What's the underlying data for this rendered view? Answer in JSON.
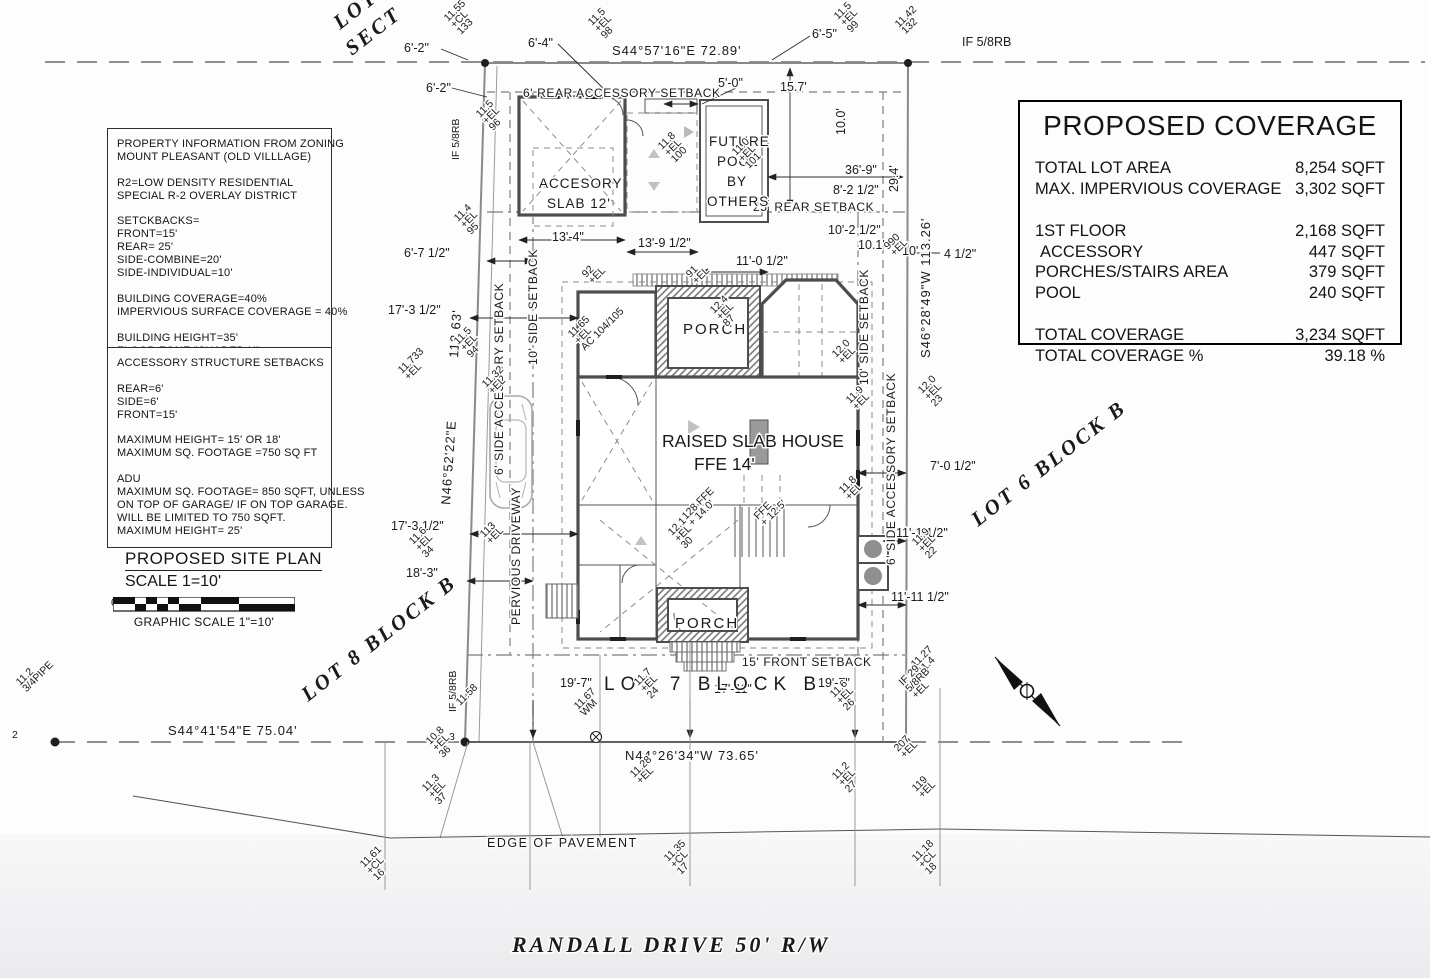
{
  "info_box1": {
    "lines": [
      "PROPERTY INFORMATION FROM ZONING",
      "MOUNT PLEASANT (OLD VILLLAGE)",
      "",
      "R2=LOW DENSITY RESIDENTIAL",
      "SPECIAL R-2 OVERLAY DISTRICT",
      "",
      "SETCKBACKS=",
      "FRONT=15'",
      "REAR= 25'",
      "SIDE-COMBINE=20'",
      "SIDE-INDIVIDUAL=10'",
      "",
      "BUILDING COVERAGE=40%",
      "IMPERVIOUS SURFACE COVERAGE = 40%",
      "",
      "BUILDING HEIGHT=35'",
      "FLOOD ZONE \"SHADED X\""
    ]
  },
  "info_box2": {
    "lines": [
      "ACCESSORY STRUCTURE SETBACKS",
      "",
      "REAR=6'",
      "SIDE=6'",
      "FRONT=15'",
      "",
      "MAXIMUM HEIGHT= 15' OR 18'",
      "MAXIMUM SQ. FOOTAGE =750 SQ FT",
      "",
      "ADU",
      "MAXIMUM SQ. FOOTAGE= 850 SQFT, UNLESS",
      "ON TOP OF GARAGE/ IF ON TOP GARAGE.",
      "WILL BE LIMITED TO 750 SQFT.",
      "MAXIMUM HEIGHT= 25'"
    ]
  },
  "site_plan": {
    "title": "PROPOSED SITE PLAN",
    "scale": "SCALE 1=10'",
    "graphic": "GRAPHIC SCALE 1\"=10'",
    "ticks": [
      "0",
      "10'",
      "20'",
      "30'"
    ]
  },
  "coverage": {
    "title": "PROPOSED COVERAGE",
    "rows": [
      {
        "label": "TOTAL LOT AREA",
        "value": "8,254 SQFT"
      },
      {
        "label": "MAX. IMPERVIOUS COVERAGE",
        "value": "3,302 SQFT"
      },
      {
        "label": "1ST FLOOR",
        "value": "2,168 SQFT",
        "gap": true
      },
      {
        "label": "ACCESSORY",
        "value": "447 SQFT",
        "indent": true
      },
      {
        "label": "PORCHES/STAIRS AREA",
        "value": "379 SQFT"
      },
      {
        "label": "POOL",
        "value": "240 SQFT"
      },
      {
        "label": "TOTAL COVERAGE",
        "value": "3,234 SQFT",
        "gap": true
      },
      {
        "label": "TOTAL COVERAGE %",
        "value": "39.18 %"
      }
    ]
  },
  "plan": {
    "labels": [
      {
        "t": "S44°57'16\"E   72.89'",
        "x": 612,
        "y": 55,
        "c": "b",
        "n": "bearing-north"
      },
      {
        "t": "N44°26'34\"W  73.65'",
        "x": 625,
        "y": 760,
        "c": "b",
        "n": "bearing-south"
      },
      {
        "t": "S44°41'54\"E  75.04'",
        "x": 168,
        "y": 735,
        "c": "b",
        "n": "bearing-southwest"
      },
      {
        "t": "N46°52'22\"E",
        "x": 450,
        "y": 505,
        "r": -86,
        "c": "b",
        "n": "bearing-west"
      },
      {
        "t": "112.63'",
        "x": 458,
        "y": 358,
        "r": -86,
        "c": "b",
        "n": "west-line-length"
      },
      {
        "t": "S46°28'49\"W 113.26'",
        "x": 930,
        "y": 358,
        "r": -90,
        "c": "b",
        "n": "bearing-east"
      },
      {
        "t": "6'-2\"",
        "x": 404,
        "y": 52,
        "c": "d"
      },
      {
        "t": "6'-2\"",
        "x": 426,
        "y": 92,
        "c": "d"
      },
      {
        "t": "6'-4\"",
        "x": 528,
        "y": 47,
        "c": "d"
      },
      {
        "t": "6'-5\"",
        "x": 812,
        "y": 38,
        "c": "d"
      },
      {
        "t": "5'-0\"",
        "x": 718,
        "y": 87,
        "c": "d"
      },
      {
        "t": "15.7'",
        "x": 780,
        "y": 91,
        "c": "d"
      },
      {
        "t": "IF 5/8RB",
        "x": 962,
        "y": 46,
        "c": "d",
        "n": "iron-found-marker"
      },
      {
        "t": "IF 5/8RB",
        "x": 459,
        "y": 160,
        "r": -90,
        "c": "v",
        "n": "iron-found-marker"
      },
      {
        "t": "IF 5/8RB",
        "x": 456,
        "y": 712,
        "r": -90,
        "c": "v",
        "n": "iron-found-marker"
      },
      {
        "t": "2",
        "x": 12,
        "y": 738,
        "c": "v",
        "n": "point-number"
      },
      {
        "t": "3",
        "x": 449,
        "y": 740,
        "c": "v",
        "n": "point-number"
      },
      {
        "t": "6' REAR ACCESSORY SETBACK",
        "x": 523,
        "y": 97,
        "c": "s",
        "n": "setback-label"
      },
      {
        "t": "25' REAR SETBACK",
        "x": 753,
        "y": 211,
        "c": "s",
        "n": "setback-label"
      },
      {
        "t": "15' FRONT SETBACK",
        "x": 742,
        "y": 666,
        "c": "s",
        "n": "setback-label"
      },
      {
        "t": "10' SIDE SETBACK",
        "x": 537,
        "y": 365,
        "r": -90,
        "c": "s",
        "n": "setback-label"
      },
      {
        "t": "6' SIDE ACCESSORY SETBACK",
        "x": 503,
        "y": 475,
        "r": -90,
        "c": "s",
        "n": "setback-label"
      },
      {
        "t": "10' SIDE SETBACK",
        "x": 868,
        "y": 385,
        "r": -90,
        "c": "s",
        "n": "setback-label"
      },
      {
        "t": "6' SIDE ACCESSORY SETBACK",
        "x": 895,
        "y": 565,
        "r": -90,
        "c": "s",
        "n": "setback-label"
      },
      {
        "t": "PERVIOUS DRIVEWAY",
        "x": 520,
        "y": 625,
        "r": -90,
        "c": "s",
        "n": "driveway-label"
      },
      {
        "t": "36'-9\"",
        "x": 845,
        "y": 174,
        "c": "d"
      },
      {
        "t": "8'-2 1/2\"",
        "x": 833,
        "y": 194,
        "c": "d"
      },
      {
        "t": "10'-2 1/2\"",
        "x": 828,
        "y": 234,
        "c": "d"
      },
      {
        "t": "10.1'",
        "x": 858,
        "y": 249,
        "c": "d"
      },
      {
        "t": "10'",
        "x": 902,
        "y": 255,
        "c": "d"
      },
      {
        "t": "4 1/2\"",
        "x": 944,
        "y": 258,
        "c": "d"
      },
      {
        "t": "29.4'",
        "x": 898,
        "y": 192,
        "r": -90,
        "c": "d"
      },
      {
        "t": "10.0'",
        "x": 845,
        "y": 135,
        "r": -90,
        "c": "d"
      },
      {
        "t": "13'-4\"",
        "x": 552,
        "y": 241,
        "c": "d"
      },
      {
        "t": "13'-9 1/2\"",
        "x": 638,
        "y": 247,
        "c": "d"
      },
      {
        "t": "11'-0 1/2\"",
        "x": 736,
        "y": 265,
        "c": "d"
      },
      {
        "t": "6'-7 1/2\"",
        "x": 404,
        "y": 257,
        "c": "d"
      },
      {
        "t": "17'-3 1/2\"",
        "x": 388,
        "y": 314,
        "c": "d"
      },
      {
        "t": "17'-3 1/2\"",
        "x": 391,
        "y": 530,
        "c": "d"
      },
      {
        "t": "18'-3\"",
        "x": 406,
        "y": 577,
        "c": "d"
      },
      {
        "t": "7'-0 1/2\"",
        "x": 930,
        "y": 470,
        "c": "d"
      },
      {
        "t": "11'-1 1/2\"",
        "x": 896,
        "y": 537,
        "c": "d"
      },
      {
        "t": "11'-11 1/2\"",
        "x": 891,
        "y": 601,
        "c": "d"
      },
      {
        "t": "19'-7\"",
        "x": 560,
        "y": 687,
        "c": "d"
      },
      {
        "t": "17'-11\"",
        "x": 714,
        "y": 693,
        "c": "d"
      },
      {
        "t": "19'-7\"",
        "x": 818,
        "y": 687,
        "c": "d"
      },
      {
        "t": "LOT",
        "x": 340,
        "y": 30,
        "r": -38,
        "c": "lot",
        "n": "lot-label-partial"
      },
      {
        "t": "SECT",
        "x": 352,
        "y": 56,
        "r": -38,
        "c": "lot",
        "n": "lot-label-partial"
      },
      {
        "t": "LOT 8 BLOCK B",
        "x": 308,
        "y": 702,
        "r": -38,
        "c": "lot",
        "n": "lot8-label"
      },
      {
        "t": "LOT 6 BLOCK B",
        "x": 978,
        "y": 527,
        "r": -38,
        "c": "lot",
        "n": "lot6-label"
      },
      {
        "t": "LOT 7 BLOCK B",
        "x": 604,
        "y": 690,
        "c": "lot7",
        "n": "lot7-label"
      },
      {
        "t": "RANDALL DRIVE   50' R/W",
        "x": 512,
        "y": 952,
        "c": "street",
        "n": "street-name"
      },
      {
        "t": "EDGE OF PAVEMENT",
        "x": 487,
        "y": 847,
        "c": "edge",
        "n": "edge-of-pavement-label"
      },
      {
        "t": "RAISED SLAB HOUSE",
        "x": 662,
        "y": 447,
        "c": "house",
        "n": "house-label"
      },
      {
        "t": "FFE  14'",
        "x": 694,
        "y": 470,
        "c": "house",
        "n": "house-ffe-label"
      },
      {
        "t": "PORCH",
        "x": 683,
        "y": 334,
        "c": "room",
        "n": "rear-porch-label"
      },
      {
        "t": "PORCH",
        "x": 675,
        "y": 628,
        "c": "room",
        "n": "front-porch-label"
      },
      {
        "t": "ACCESORY",
        "x": 539,
        "y": 188,
        "c": "bldg",
        "n": "accessory-slab-label"
      },
      {
        "t": "SLAB 12'",
        "x": 547,
        "y": 208,
        "c": "bldg",
        "n": "accessory-slab-label"
      },
      {
        "t": "FUTURE",
        "x": 709,
        "y": 146,
        "c": "bldg",
        "n": "pool-label"
      },
      {
        "t": "POOL",
        "x": 717,
        "y": 166,
        "c": "bldg",
        "n": "pool-label"
      },
      {
        "t": "BY",
        "x": 727,
        "y": 186,
        "c": "bldg",
        "n": "pool-label"
      },
      {
        "t": "OTHERS",
        "x": 707,
        "y": 206,
        "c": "bldg",
        "n": "pool-label"
      }
    ],
    "spot_markers": [
      {
        "x": 448,
        "y": 22,
        "lines": [
          "11.55",
          "+CL",
          "133"
        ]
      },
      {
        "x": 592,
        "y": 26,
        "lines": [
          "11.5",
          "+EL",
          "98"
        ]
      },
      {
        "x": 838,
        "y": 20,
        "lines": [
          "11.5",
          "+EL",
          "99"
        ]
      },
      {
        "x": 899,
        "y": 28,
        "lines": [
          "11.42",
          "132"
        ]
      },
      {
        "x": 480,
        "y": 118,
        "lines": [
          "11.5",
          "+EL",
          "96"
        ]
      },
      {
        "x": 458,
        "y": 222,
        "lines": [
          "11.4",
          "+EL",
          "95"
        ]
      },
      {
        "x": 458,
        "y": 345,
        "lines": [
          "11.5",
          "+EL",
          "94"
        ]
      },
      {
        "x": 402,
        "y": 374,
        "lines": [
          "11.733",
          "+EL"
        ]
      },
      {
        "x": 486,
        "y": 388,
        "lines": [
          "11.32",
          "+EL"
        ]
      },
      {
        "x": 413,
        "y": 545,
        "lines": [
          "11.6",
          "+EL",
          "34"
        ]
      },
      {
        "x": 484,
        "y": 538,
        "lines": [
          "113",
          "+EL"
        ]
      },
      {
        "x": 460,
        "y": 706,
        "lines": [
          "11.58"
        ]
      },
      {
        "x": 430,
        "y": 745,
        "lines": [
          "10.8",
          "+EL",
          "36"
        ]
      },
      {
        "x": 426,
        "y": 792,
        "lines": [
          "11.3",
          "+EL",
          "37"
        ]
      },
      {
        "x": 20,
        "y": 686,
        "lines": [
          "11.2",
          "3/4PIPE"
        ]
      },
      {
        "x": 578,
        "y": 710,
        "lines": [
          "11.67",
          "WM"
        ]
      },
      {
        "x": 638,
        "y": 686,
        "lines": [
          "11.7",
          "+EL",
          "24"
        ]
      },
      {
        "x": 834,
        "y": 698,
        "lines": [
          "11.6",
          "+EL",
          "26"
        ]
      },
      {
        "x": 836,
        "y": 780,
        "lines": [
          "11.2",
          "+EL",
          "27"
        ]
      },
      {
        "x": 634,
        "y": 778,
        "lines": [
          "11.28",
          "+EL"
        ]
      },
      {
        "x": 898,
        "y": 752,
        "lines": [
          "207",
          "+EL"
        ]
      },
      {
        "x": 916,
        "y": 792,
        "lines": [
          "119",
          "+EL"
        ]
      },
      {
        "x": 922,
        "y": 394,
        "lines": [
          "12.0",
          "+EL",
          "23"
        ]
      },
      {
        "x": 916,
        "y": 546,
        "lines": [
          "11.9",
          "+EL",
          "22"
        ]
      },
      {
        "x": 888,
        "y": 250,
        "lines": [
          "990",
          "+EL"
        ]
      },
      {
        "x": 662,
        "y": 150,
        "lines": [
          "11.8",
          "+EL",
          "100"
        ]
      },
      {
        "x": 736,
        "y": 156,
        "lines": [
          "11.0",
          "+EL",
          "101"
        ]
      },
      {
        "x": 572,
        "y": 338,
        "lines": [
          "11.65",
          "+EL",
          "AC 104/105"
        ]
      },
      {
        "x": 714,
        "y": 314,
        "lines": [
          "12.4",
          "+EL",
          "87"
        ]
      },
      {
        "x": 836,
        "y": 358,
        "lines": [
          "12.0",
          "+EL"
        ]
      },
      {
        "x": 850,
        "y": 404,
        "lines": [
          "11.9",
          "+EL"
        ]
      },
      {
        "x": 672,
        "y": 536,
        "lines": [
          "12.1",
          "+EL",
          "30"
        ]
      },
      {
        "x": 686,
        "y": 520,
        "lines": [
          "128 FFE",
          "+ 14.0'"
        ]
      },
      {
        "x": 758,
        "y": 520,
        "lines": [
          "FFE",
          "+ 12.5'"
        ]
      },
      {
        "x": 843,
        "y": 494,
        "lines": [
          "11.8",
          "+EL"
        ]
      },
      {
        "x": 586,
        "y": 278,
        "lines": [
          "92",
          "+EL"
        ]
      },
      {
        "x": 690,
        "y": 278,
        "lines": [
          "91",
          "+EL"
        ]
      },
      {
        "x": 915,
        "y": 668,
        "lines": [
          "11.27",
          "11.4"
        ]
      },
      {
        "x": 903,
        "y": 686,
        "lines": [
          "IF 29",
          "5/8RB",
          "+EL"
        ]
      },
      {
        "x": 364,
        "y": 868,
        "lines": [
          "11.61",
          "+CL",
          "16"
        ]
      },
      {
        "x": 668,
        "y": 862,
        "lines": [
          "11.35",
          "+CL",
          "17"
        ]
      },
      {
        "x": 916,
        "y": 862,
        "lines": [
          "11.18",
          "+CL",
          "18"
        ]
      }
    ]
  }
}
